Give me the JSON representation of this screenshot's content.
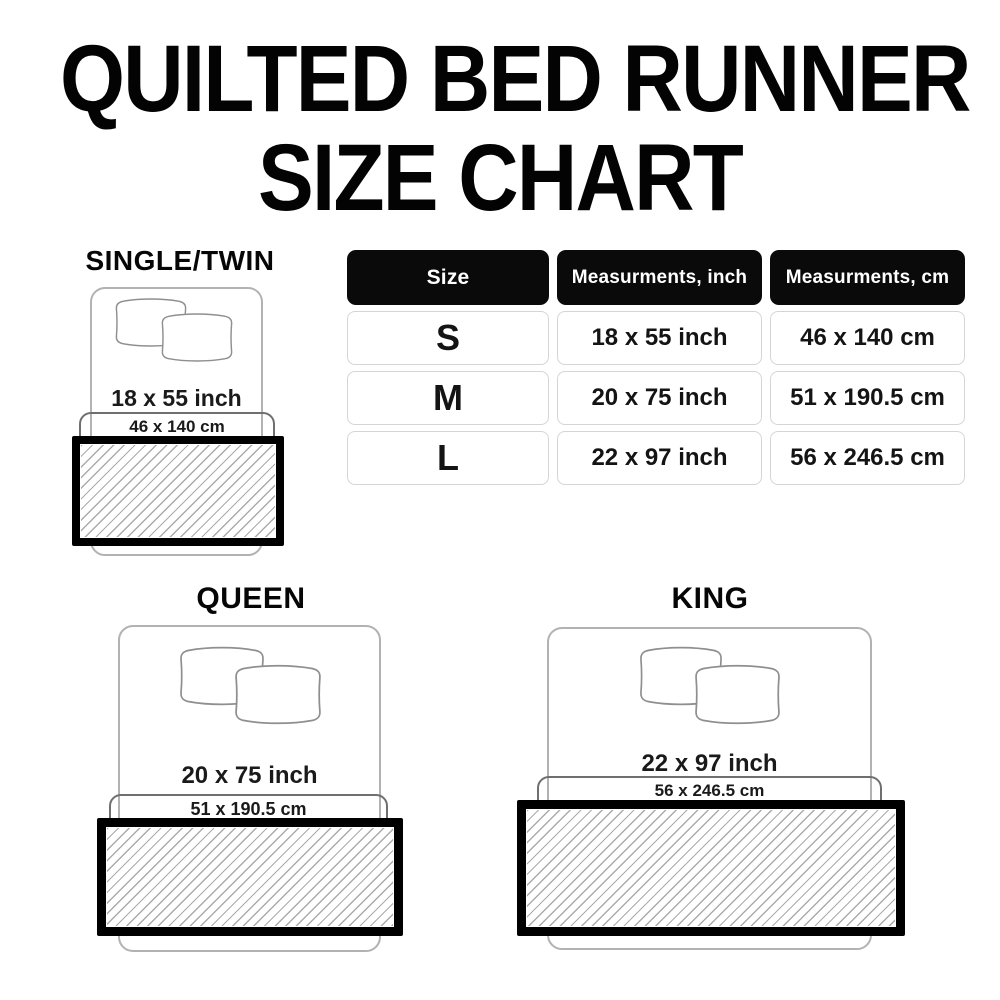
{
  "title": {
    "line1": "QUILTED BED RUNNER",
    "line2": "SIZE CHART"
  },
  "table": {
    "headers": {
      "size": "Size",
      "inch": "Measurments, inch",
      "cm": "Measurments, cm"
    },
    "rows": [
      {
        "size": "S",
        "inch": "18 x 55 inch",
        "cm": "46 x 140 cm"
      },
      {
        "size": "M",
        "inch": "20 x 75 inch",
        "cm": "51 x 190.5 cm"
      },
      {
        "size": "L",
        "inch": "22 x 97 inch",
        "cm": "56 x 246.5 cm"
      }
    ]
  },
  "diagrams": [
    {
      "label": "SINGLE/TWIN",
      "inch": "18 x 55 inch",
      "cm": "46 x 140 cm"
    },
    {
      "label": "QUEEN",
      "inch": "20 x 75 inch",
      "cm": "51 x 190.5 cm"
    },
    {
      "label": "KING",
      "inch": "22 x 97 inch",
      "cm": "56 x 246.5 cm"
    }
  ],
  "colors": {
    "background": "#ffffff",
    "text": "#000000",
    "header_bg": "#0a0a0a",
    "header_text": "#ffffff",
    "cell_border": "#d5d5d5",
    "bed_outline": "#b2b2b2",
    "bracket_outline": "#6f6f6f",
    "pillow_outline": "#8f8f8f",
    "hatch_line": "#ababab",
    "runner_border": "#000000"
  }
}
